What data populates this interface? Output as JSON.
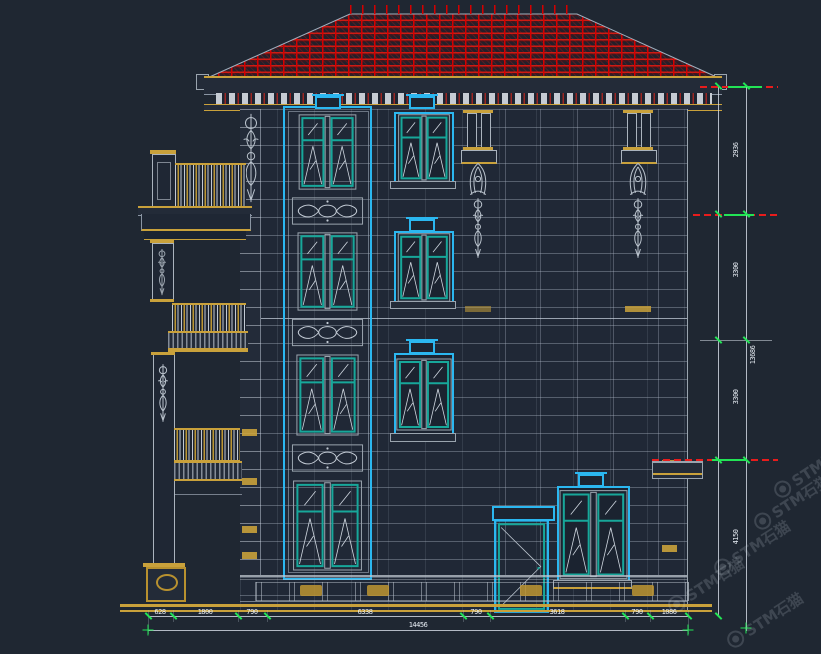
{
  "app": {
    "type": "cad-elevation-drawing",
    "subject": "villa front elevation with red tile hip roof, stone facade, balustraded side wing"
  },
  "canvas": {
    "width": 821,
    "height": 654,
    "background": "#1f2732"
  },
  "colors": {
    "roof_red": "#d40000",
    "window_frame_cyan": "#2bb7f0",
    "sash_teal": "#17a79a",
    "trim_gold": "#c9a13b",
    "line_gray": "#aab3bd",
    "dimension_green": "#22e455",
    "level_line_red": "#e81c1c",
    "dimension_text": "#e9eff6"
  },
  "dimensions": {
    "bottom": {
      "segments": [
        "628",
        "1800",
        "790",
        "6338",
        "790",
        "3618",
        "790",
        "1086"
      ],
      "total": "14456"
    },
    "right": {
      "segments": [
        "2936",
        "3300",
        "3300",
        "4150"
      ],
      "total": "13686"
    }
  },
  "watermark": {
    "brand": "STM石猫"
  }
}
